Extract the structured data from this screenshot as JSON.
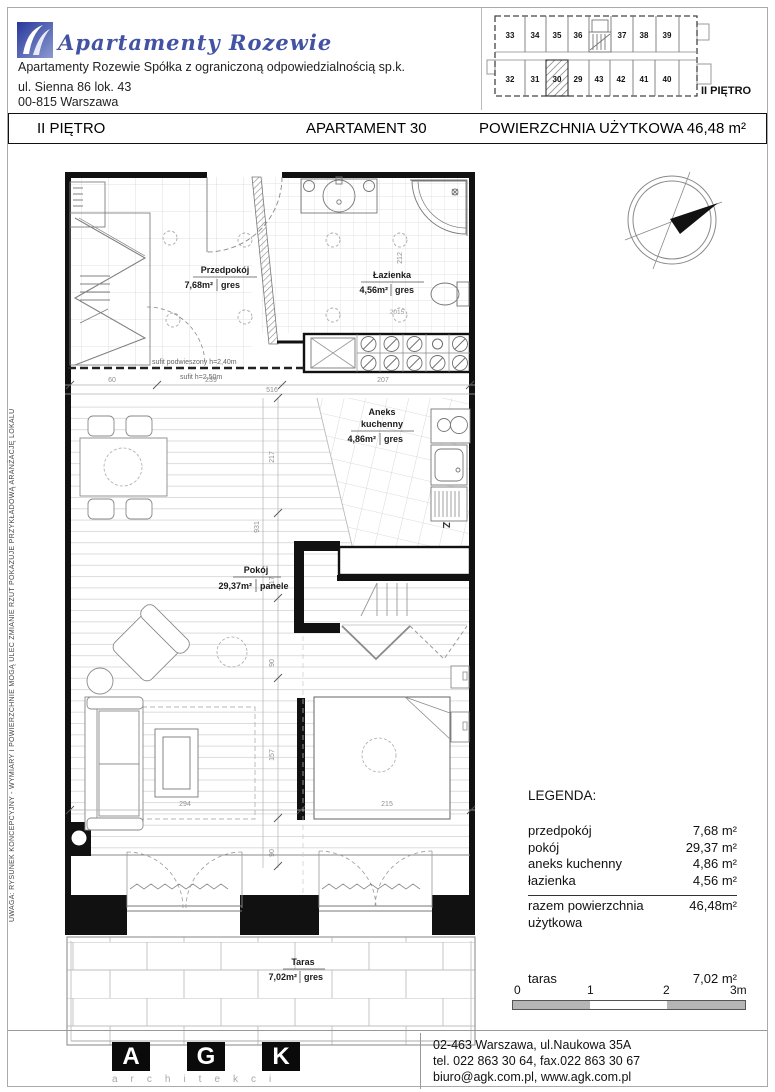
{
  "colors": {
    "brand_blue": "#4353a4",
    "logo_blue_dark": "#27379b",
    "logo_blue_light": "#8d9ad0",
    "wall": "#111111",
    "dim_gray": "#8f8f8f",
    "scale_gray": "#b5b5b5"
  },
  "header": {
    "brand": "Apartamenty Rozewie",
    "company_name": "Apartamenty Rozewie Spółka z ograniczoną odpowiedzialnością sp.k.",
    "company_addr1": "ul. Sienna 86 lok. 43",
    "company_addr2": "00-815 Warszawa"
  },
  "title_bar": {
    "floor": "II PIĘTRO",
    "apartment": "APARTAMENT 30",
    "area": "POWIERZCHNIA UŻYTKOWA 46,48 m²"
  },
  "overview": {
    "floor_label": "II PIĘTRO",
    "highlighted_unit": "30",
    "top_units": [
      "33",
      "34",
      "35",
      "36",
      "37",
      "38",
      "39"
    ],
    "bottom_units": [
      "32",
      "31",
      "30",
      "29",
      "43",
      "42",
      "41",
      "40"
    ]
  },
  "plan": {
    "rooms": {
      "przedpokoj": {
        "name": "Przedpokój",
        "area": "7,68m²",
        "floor": "gres"
      },
      "lazienka": {
        "name": "Łazienka",
        "area": "4,56m²",
        "floor": "gres"
      },
      "aneks": {
        "name_line1": "Aneks",
        "name_line2": "kuchenny",
        "area": "4,86m²",
        "floor": "gres"
      },
      "pokoj": {
        "name": "Pokój",
        "area": "29,37m²",
        "floor": "panele"
      },
      "taras": {
        "name": "Taras",
        "area": "7,02m²",
        "floor": "gres"
      }
    },
    "ceiling": {
      "suspended": "sufit podwieszony h=2,40m",
      "standard": "sufit h=2,50m"
    },
    "dims": {
      "d60": "60",
      "d239": "239",
      "d516": "516",
      "d207": "207",
      "d212": "212",
      "d2015": "2015",
      "d217": "217",
      "d931": "931",
      "d117": "117",
      "d90a": "90",
      "d157": "157",
      "d90b": "90",
      "d294": "294",
      "d215": "215"
    },
    "appliance_z": "Z"
  },
  "legend": {
    "title": "LEGENDA:",
    "rows": [
      {
        "label": "przedpokój",
        "value": "7,68 m²"
      },
      {
        "label": "pokój",
        "value": "29,37 m²"
      },
      {
        "label": "aneks kuchenny",
        "value": "4,86 m²"
      },
      {
        "label": "łazienka",
        "value": "4,56 m²"
      }
    ],
    "total_label": "razem powierzchnia użytkowa",
    "total_value": "46,48m²",
    "taras_label": "taras",
    "taras_value": "7,02 m²"
  },
  "scalebar": {
    "t0": "0",
    "t1": "1",
    "t2": "2",
    "t3": "3m"
  },
  "footer": {
    "letters": [
      "A",
      "G",
      "K"
    ],
    "caption": "architekci",
    "address1": "02-463 Warszawa, ul.Naukowa 35A",
    "address2": "tel. 022 863 30 64, fax.022 863 30 67",
    "address3": "biuro@agk.com.pl, www.agk.com.pl"
  },
  "disclaimer": "UWAGA: RYSUNEK KONCEPCYJNY - WYMIARY I POWIERZCHNIE MOGĄ ULEC ZMIANIE  RZUT POKAZUJE PRZYKŁADOWĄ ARANŻACJĘ LOKALU"
}
